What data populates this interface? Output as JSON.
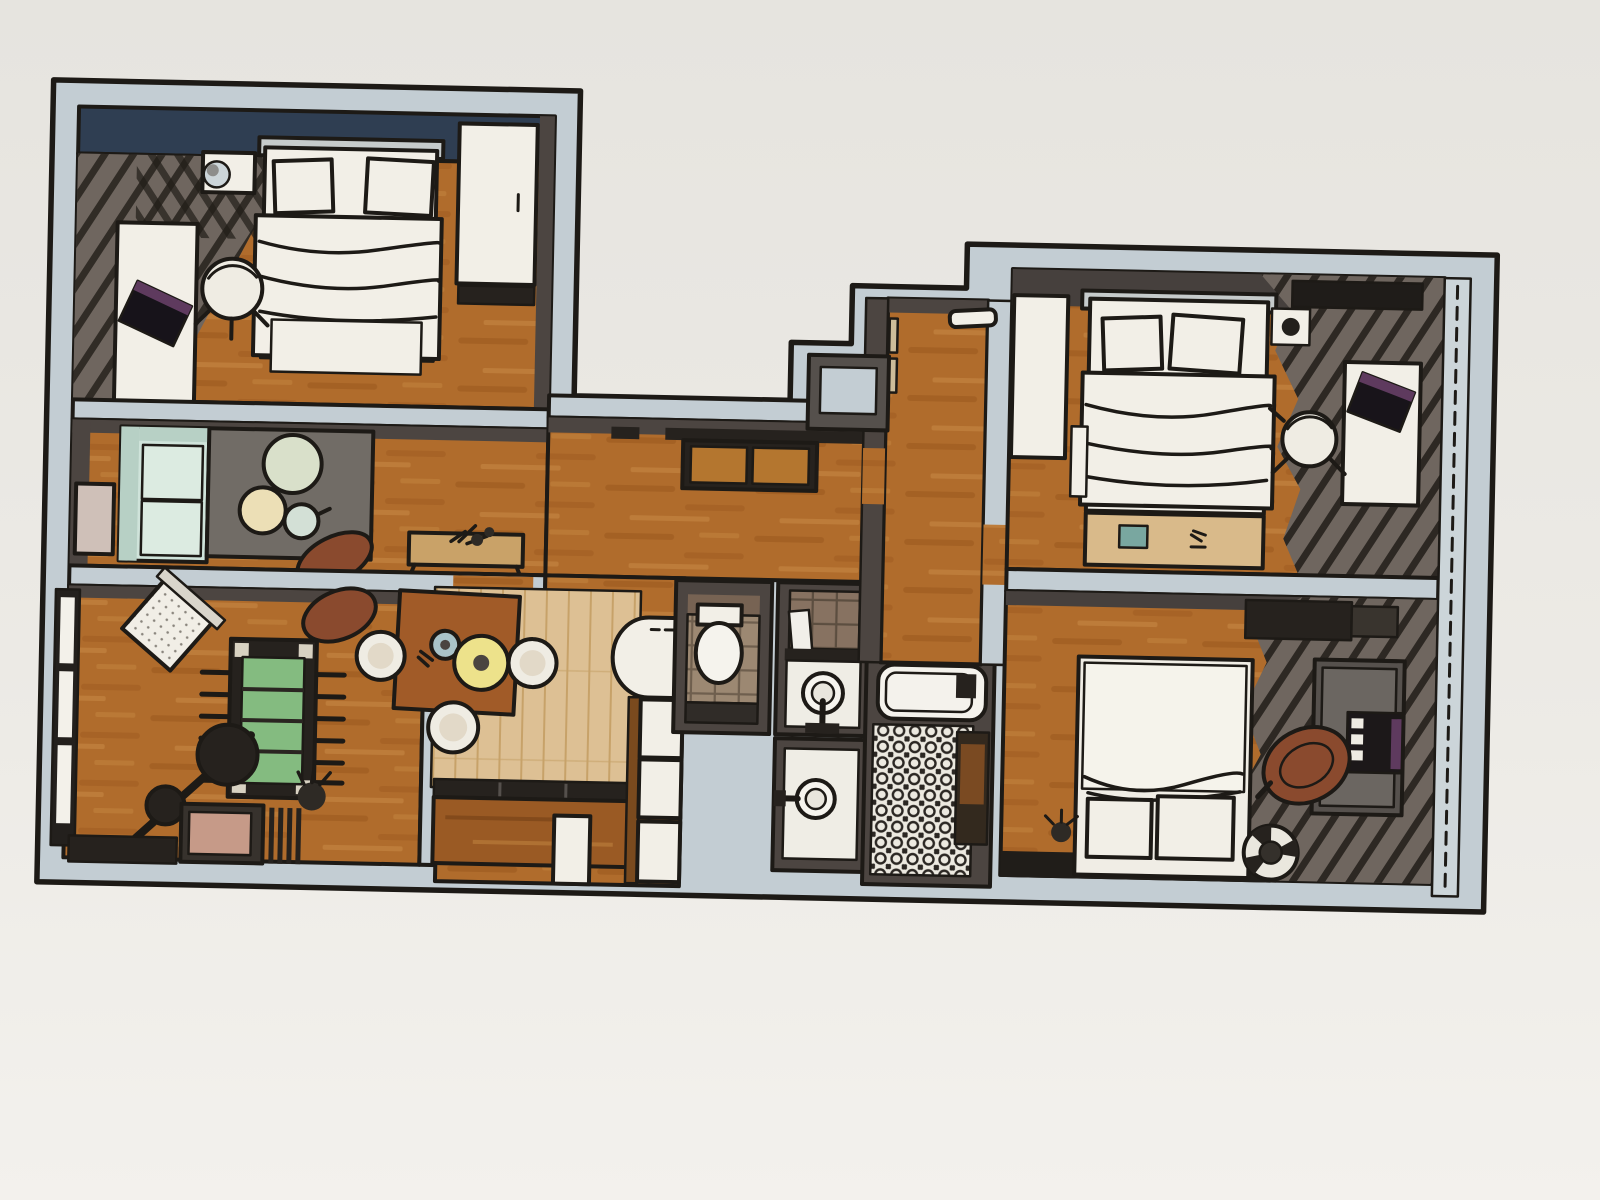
{
  "scene": {
    "type": "photographed 3d rendered apartment floor plan, top-down cutaway view",
    "rooms": [
      {
        "name": "bedroom-top-left",
        "wall_accent": "navy",
        "furniture": [
          "double-bed",
          "wardrobe",
          "nightstand-with-lamp",
          "desk",
          "laptop",
          "office-chair",
          "curtain-shadow"
        ]
      },
      {
        "name": "lounge-nook",
        "furniture": [
          "mint-sofa",
          "gray-area-rug",
          "round-coffee-table-large",
          "round-coffee-table-cream",
          "round-coffee-table-small",
          "leather-armchair",
          "console-table-with-plant",
          "small-window"
        ]
      },
      {
        "name": "game-room",
        "furniture": [
          "foosball-table",
          "guitar",
          "amp-cabinet",
          "slat-bench",
          "quilted-armchair",
          "leather-chair",
          "plant",
          "tall-windows"
        ]
      },
      {
        "name": "hallway",
        "furniture": [
          "entry-bench-two-cushions"
        ]
      },
      {
        "name": "dining-kitchen",
        "furniture": [
          "dining-table",
          "tub-chair",
          "tub-chair",
          "tub-chair",
          "blue-plate",
          "yellow-platter",
          "light-parquet-rug",
          "banquette",
          "rounded-counter",
          "tall-white-cabinets",
          "white-door"
        ]
      },
      {
        "name": "wc",
        "furniture": [
          "toilet",
          "vanity",
          "tiled-floor"
        ]
      },
      {
        "name": "washroom-upper",
        "furniture": [
          "round-sink",
          "mirror",
          "tiled-wall",
          "shelf"
        ]
      },
      {
        "name": "washroom-lower",
        "furniture": [
          "round-sink"
        ]
      },
      {
        "name": "bathroom",
        "furniture": [
          "bathtub",
          "mosaic-floor",
          "wood-cabinet"
        ]
      },
      {
        "name": "entry-corridor",
        "furniture": [
          "wall-shelf",
          "service-duct",
          "door-frames"
        ]
      },
      {
        "name": "bedroom-right-top",
        "furniture": [
          "double-bed",
          "wardrobe",
          "nightstand",
          "desk",
          "laptop",
          "desk-chair",
          "low-bench-with-photo",
          "curtain-shadow",
          "window-wall"
        ]
      },
      {
        "name": "bedroom-right-bottom",
        "furniture": [
          "double-bed",
          "dark-wardrobe",
          "desk",
          "laptop",
          "leather-swivel-chair",
          "striped-pouf",
          "dark-rug",
          "plant",
          "curtain-shadow",
          "window-wall"
        ]
      }
    ]
  },
  "palette": {
    "paper_top": "#e6e4df",
    "paper_mid": "#eceae5",
    "paper_bottom": "#f3f1ed",
    "wall_cut": "#c3cdd3",
    "wall_face": "#4c4541",
    "wall_face_light": "#55504c",
    "outline": "#1d1a16",
    "wood_base": "#b06c2c",
    "wood_dark": "#95541b",
    "wood_light": "#c98b47",
    "parquet": "#ddc094",
    "parquet_line": "#c7a269",
    "navy": "#2f3e52",
    "shadow": "#6f665f",
    "mint": "#cfe3da",
    "mint_dark": "#b7d0c5",
    "mint_light": "#dcebe1",
    "rug": "#716c66",
    "table_green": "#d9e0ca",
    "table_cream": "#ecdfb6",
    "table_mint": "#d3e0d6",
    "leather": "#8a4a2e",
    "white": "#f2efe7",
    "chair_white": "#efece3",
    "yellow": "#ede28b",
    "blue": "#a9c3c9",
    "foosball": "#84bb80",
    "bench_orange": "#b4762f",
    "tile": "#9c8872",
    "tile_line": "#6f5f4e",
    "tile_wall": "#877261",
    "mosaic_bg": "#ece9e0",
    "window_pink": "#cfc0b8",
    "dark_furn": "#26221e",
    "desk_gray": "#56514d",
    "laptop_purple": "#5e3a5e",
    "glass": "#ccd5d9",
    "photo_teal": "#79a7a0",
    "door_tan": "#cdbd9a",
    "banquette_wood": "#9a5a24",
    "amp_pink": "#c69a88",
    "table_wood": "#a15b28"
  }
}
